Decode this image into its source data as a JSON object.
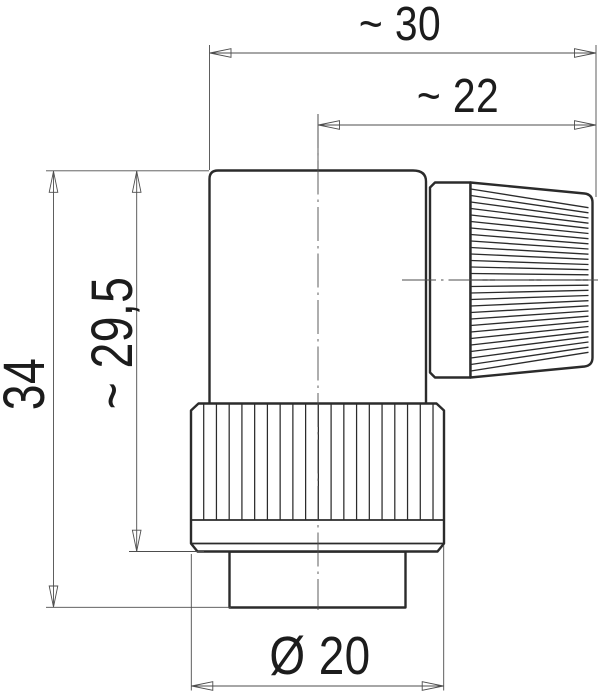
{
  "drawing": {
    "dimensions": {
      "overall_width": "~ 30",
      "cable_side_width": "~ 22",
      "overall_height": "34",
      "body_height": "~ 29,5",
      "coupling_diameter": "Ø 20"
    }
  },
  "colors": {
    "outline": "#2b2b2b",
    "thin": "#4d4d4d",
    "text": "#1c1c1c",
    "background": "#ffffff"
  }
}
